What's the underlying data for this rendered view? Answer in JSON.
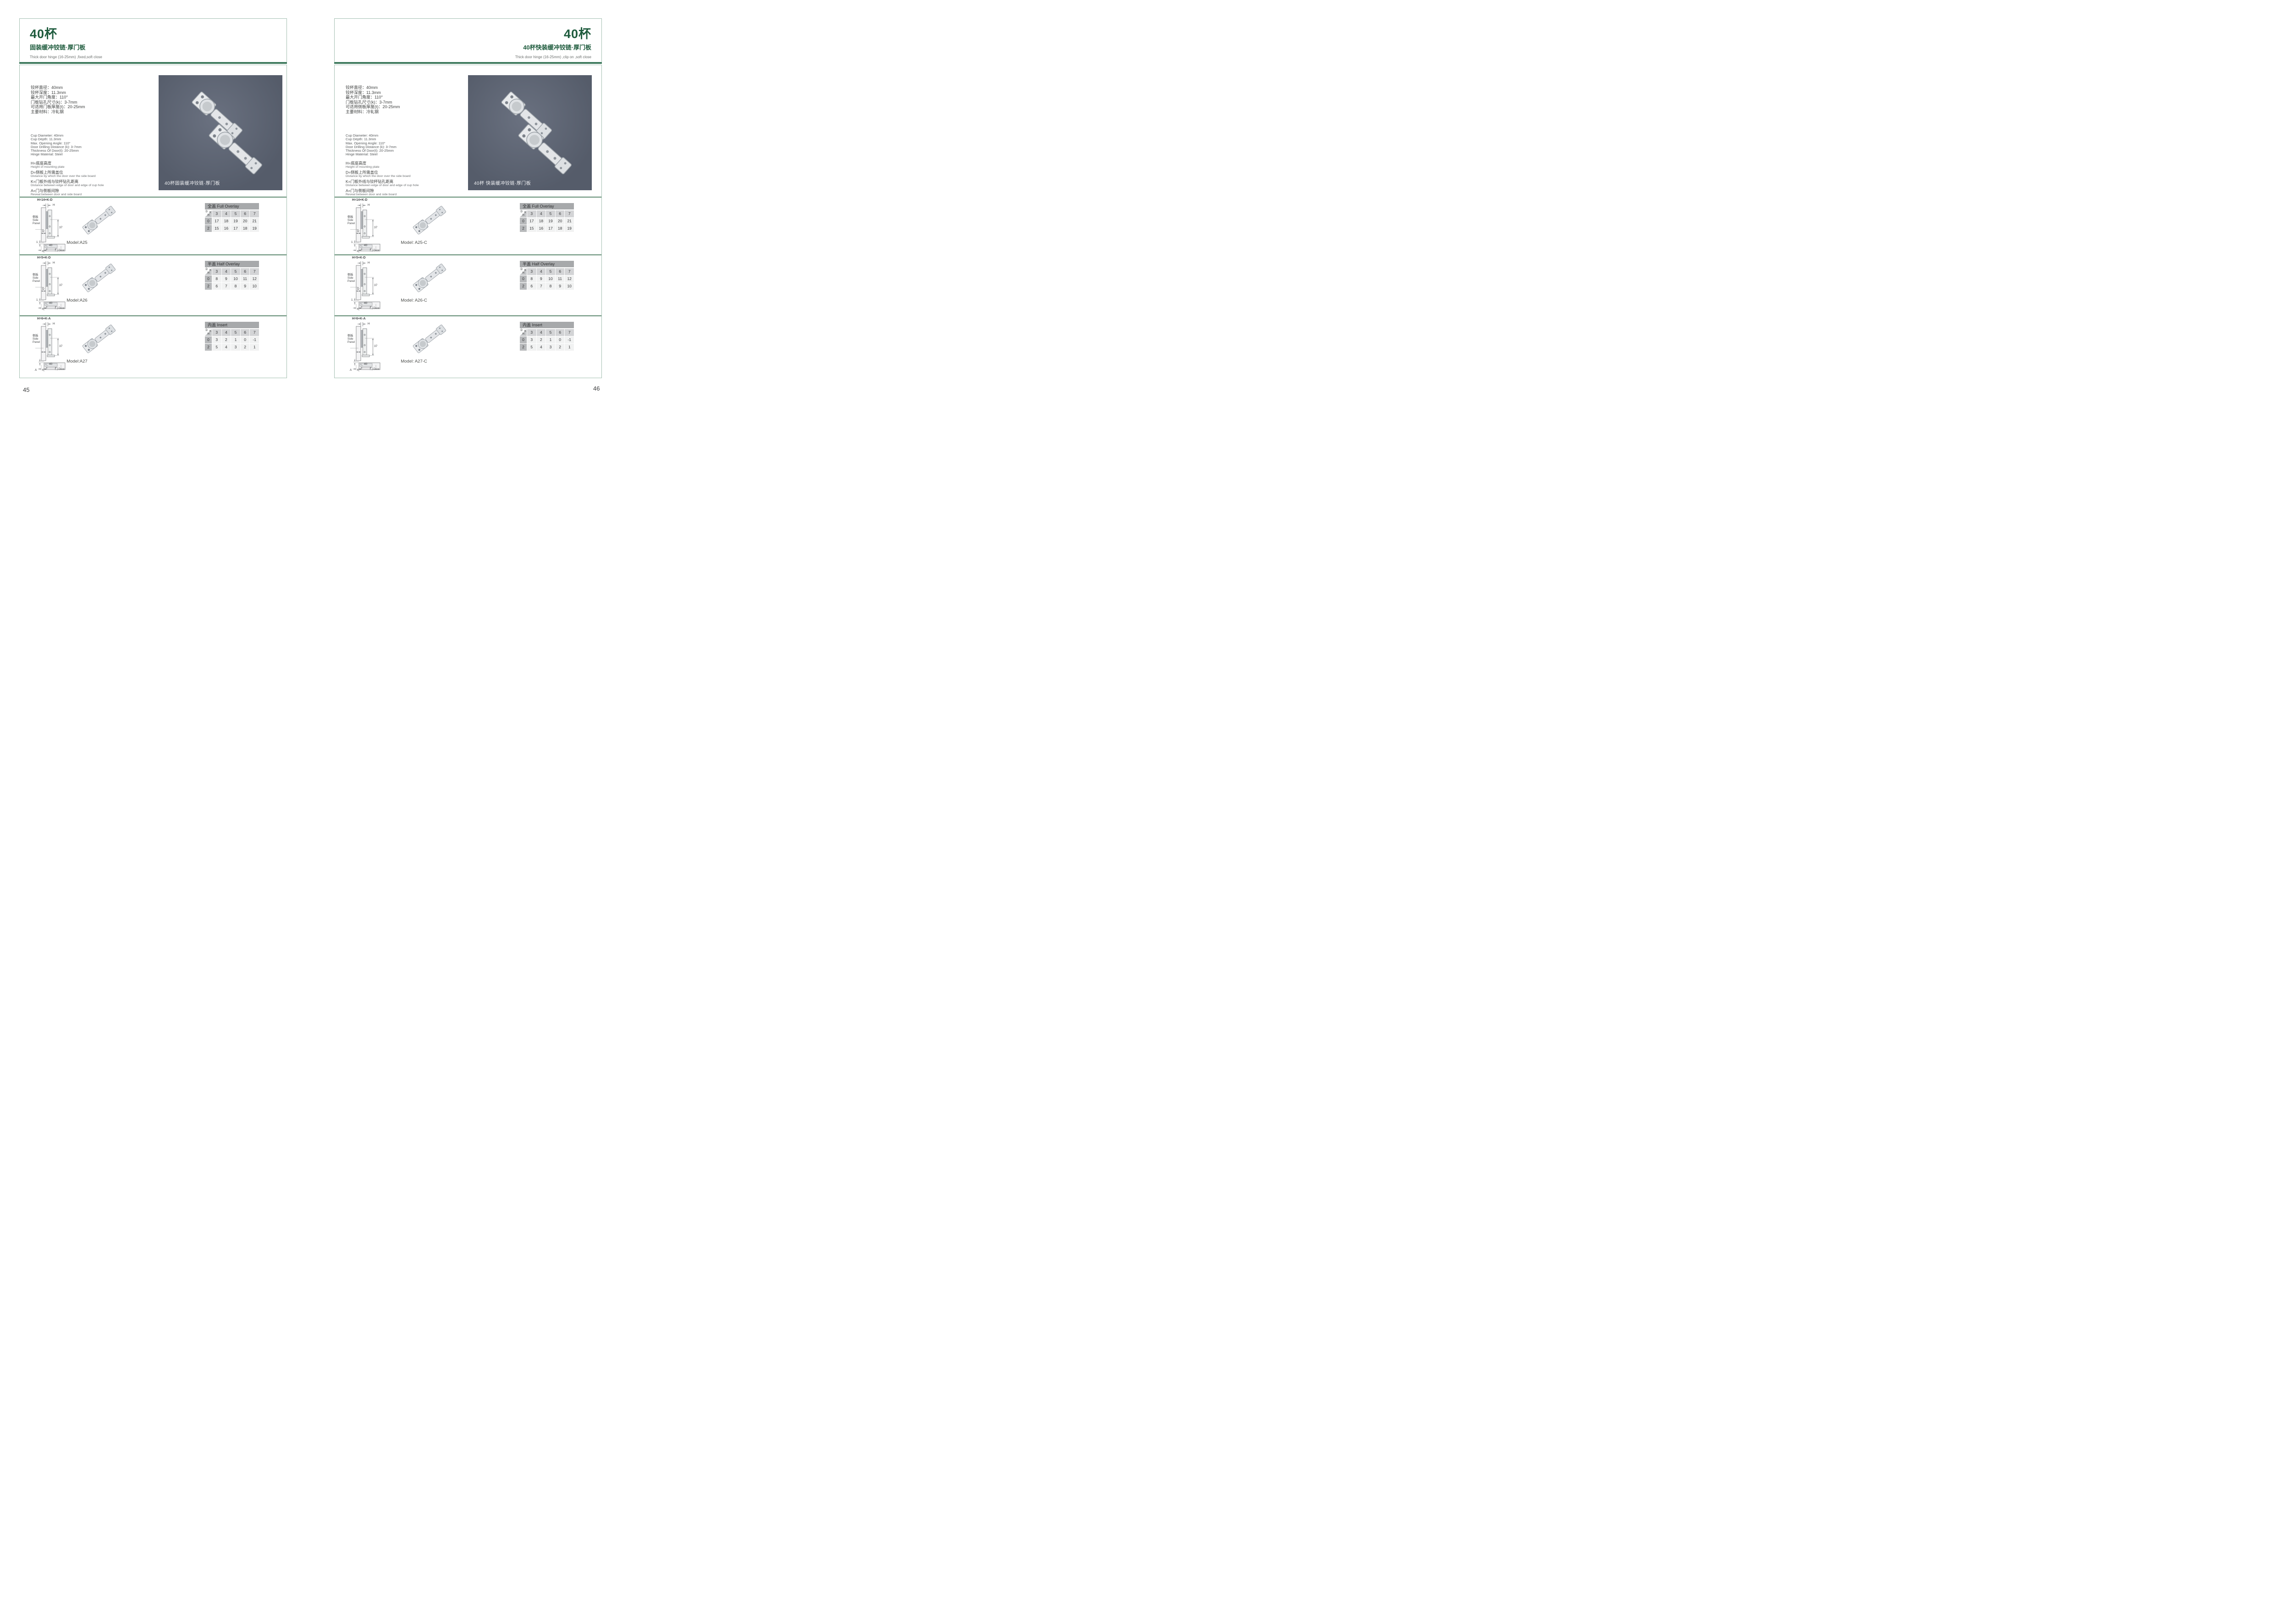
{
  "colors": {
    "title_green": "#1e5b3d",
    "box_border_green": "#a3bfb1",
    "thick_divider_green": "#276a4a",
    "section_separator_green": "#5e8a71",
    "table_titlebar_gray": "#a7a9ab",
    "table_header_gray": "#d3d4d6",
    "table_rowhead_gray": "#b7b9bb",
    "table_cell_gray": "#f1f2f2",
    "photo_background": "#59606f"
  },
  "pages": [
    {
      "page_number": "45",
      "header": {
        "title": "40杯",
        "subtitle": "固装缓冲铰链·厚门板",
        "subtitle_en": "Thick door hinge (16-25mm)  ,fixed,soft close"
      },
      "specs_cn": [
        "铰杯直径：40mm",
        "铰杯深度：11.3mm",
        "最大开门角度：110°",
        "门板钻孔尺寸(k)：3-7mm",
        "可适用门板厚度(t)：20-25mm",
        "主要材料：冷轧钢"
      ],
      "specs_en": [
        "Cup Diameter: 40mm",
        "Cup Depth: 11.3mm",
        "Max. Opening Angle: 110°",
        "Door Drilling Distance (k): 3-7mm",
        "Thickness Of Door(t): 20-25mm",
        "Hinge Material: Steel"
      ],
      "definitions": [
        {
          "cn": "H=底座高度",
          "en": "Height of mounting plate"
        },
        {
          "cn": "D=侧板上所需盖位",
          "en": "Distance by which the door over the side board"
        },
        {
          "cn": "K=门板外线与铰杯钻孔距离",
          "en": "Distance between edge of door and edge of cup hole"
        },
        {
          "cn": "A=门与侧板间隙",
          "en": "Reveal between door and side board"
        }
      ],
      "photo_caption": "40杯固装缓冲铰链·厚门板",
      "rows": [
        {
          "model": "Model:A25",
          "diagram": {
            "formula": "H=14+K-D",
            "h": "H",
            "side_cn": "侧板",
            "side_en1": "Side",
            "side_en2": "Panel",
            "d": "D",
            "dim37": "37",
            "one": "1",
            "dim40": "40",
            "k": "K",
            "door": "门 Door"
          },
          "table": {
            "title": "全盖 Full Overlay",
            "corner": {
              "d": "D",
              "k": "K",
              "h": "H"
            },
            "k_values": [
              "3",
              "4",
              "5",
              "6",
              "7"
            ],
            "rows": [
              {
                "h": "0",
                "values": [
                  "17",
                  "18",
                  "19",
                  "20",
                  "21"
                ]
              },
              {
                "h": "2",
                "values": [
                  "15",
                  "16",
                  "17",
                  "18",
                  "19"
                ]
              }
            ]
          }
        },
        {
          "model": "Model:A26",
          "diagram": {
            "formula": "H=5+K-D",
            "h": "H",
            "side_cn": "侧板",
            "side_en1": "Side",
            "side_en2": "Panel",
            "d": "D",
            "dim37": "37",
            "one": "1",
            "dim40": "40",
            "k": "K",
            "door": "门 Door"
          },
          "table": {
            "title": "半盖 Half Overlay",
            "corner": {
              "d": "D",
              "k": "K",
              "h": "H"
            },
            "k_values": [
              "3",
              "4",
              "5",
              "6",
              "7"
            ],
            "rows": [
              {
                "h": "0",
                "values": [
                  "8",
                  "9",
                  "10",
                  "11",
                  "12"
                ]
              },
              {
                "h": "2",
                "values": [
                  "6",
                  "7",
                  "8",
                  "9",
                  "10"
                ]
              }
            ]
          }
        },
        {
          "model": "Model:A27",
          "diagram": {
            "formula": "H=6+K-A",
            "h": "H",
            "side_cn": "侧板",
            "side_en1": "Side",
            "side_en2": "Panel",
            "dim37": "37",
            "dim40": "40",
            "k": "K",
            "a": "A",
            "door": "门 Door"
          },
          "table": {
            "title": "内盖 Insert",
            "corner": {
              "d": "D",
              "k": "K",
              "h": "H"
            },
            "k_values": [
              "3",
              "4",
              "5",
              "6",
              "7"
            ],
            "rows": [
              {
                "h": "0",
                "values": [
                  "3",
                  "2",
                  "1",
                  "0",
                  "-1"
                ]
              },
              {
                "h": "2",
                "values": [
                  "5",
                  "4",
                  "3",
                  "2",
                  "1"
                ]
              }
            ]
          }
        }
      ]
    },
    {
      "page_number": "46",
      "header": {
        "title": "40杯",
        "subtitle": "40杯快装缓冲铰链·厚门板",
        "subtitle_en": "Thick door hinge (16-25mm)  ,clip on ,soft close"
      },
      "specs_cn": [
        "铰杯直径：40mm",
        "铰杯深度：11.3mm",
        "最大开门角度：110°",
        "门板钻孔尺寸(k)：3-7mm",
        "可适用侧板厚度(t)：20-25mm",
        "主要材料：冷轧钢"
      ],
      "specs_en": [
        "Cup Diameter: 40mm",
        "Cup Depth: 11.3mm",
        "Max. Opening Angle: 110°",
        "Door Drilling Distance (k): 3-7mm",
        "Thickness Of Door(t): 20-25mm",
        "Hinge Material: Steel"
      ],
      "definitions": [
        {
          "cn": "H=底座高度",
          "en": "Height of mounting plate"
        },
        {
          "cn": "D=侧板上所需盖位",
          "en": "Distance by which the door over the side board"
        },
        {
          "cn": "K=门板外线与铰杯钻孔距离",
          "en": "Distance between edge of door and edge of cup hole"
        },
        {
          "cn": "A=门与侧板间隙",
          "en": "Reveal between door and side board"
        }
      ],
      "photo_caption": "40杯 快装缓冲铰链·厚门板",
      "rows": [
        {
          "model": "Model: A25-C",
          "diagram": {
            "formula": "H=14+K-D",
            "h": "H",
            "side_cn": "侧板",
            "side_en1": "Side",
            "side_en2": "Panel",
            "d": "D",
            "dim37": "37",
            "one": "1",
            "dim40": "40",
            "k": "K",
            "door": "门 Door"
          },
          "table": {
            "title": "全盖 Full Overlay",
            "corner": {
              "d": "D",
              "k": "K",
              "h": "H"
            },
            "k_values": [
              "3",
              "4",
              "5",
              "6",
              "7"
            ],
            "rows": [
              {
                "h": "0",
                "values": [
                  "17",
                  "18",
                  "19",
                  "20",
                  "21"
                ]
              },
              {
                "h": "2",
                "values": [
                  "15",
                  "16",
                  "17",
                  "18",
                  "19"
                ]
              }
            ]
          }
        },
        {
          "model": "Model: A26-C",
          "diagram": {
            "formula": "H=5+K-D",
            "h": "H",
            "side_cn": "侧板",
            "side_en1": "Side",
            "side_en2": "Panel",
            "d": "D",
            "dim37": "37",
            "one": "1",
            "dim40": "40",
            "k": "K",
            "door": "门 Door"
          },
          "table": {
            "title": "半盖 Half Overlay",
            "corner": {
              "d": "D",
              "k": "K",
              "h": "H"
            },
            "k_values": [
              "3",
              "4",
              "5",
              "6",
              "7"
            ],
            "rows": [
              {
                "h": "0",
                "values": [
                  "8",
                  "9",
                  "10",
                  "11",
                  "12"
                ]
              },
              {
                "h": "2",
                "values": [
                  "6",
                  "7",
                  "8",
                  "9",
                  "10"
                ]
              }
            ]
          }
        },
        {
          "model": "Model: A27-C",
          "diagram": {
            "formula": "H=6+K-A",
            "h": "H",
            "side_cn": "侧板",
            "side_en1": "Side",
            "side_en2": "Panel",
            "dim37": "37",
            "dim40": "40",
            "k": "K",
            "a": "A",
            "door": "门 Door"
          },
          "table": {
            "title": "内盖 Insert",
            "corner": {
              "d": "D",
              "k": "K",
              "h": "H"
            },
            "k_values": [
              "3",
              "4",
              "5",
              "6",
              "7"
            ],
            "rows": [
              {
                "h": "0",
                "values": [
                  "3",
                  "2",
                  "1",
                  "0",
                  "-1"
                ]
              },
              {
                "h": "2",
                "values": [
                  "5",
                  "4",
                  "3",
                  "2",
                  "1"
                ]
              }
            ]
          }
        }
      ]
    }
  ]
}
